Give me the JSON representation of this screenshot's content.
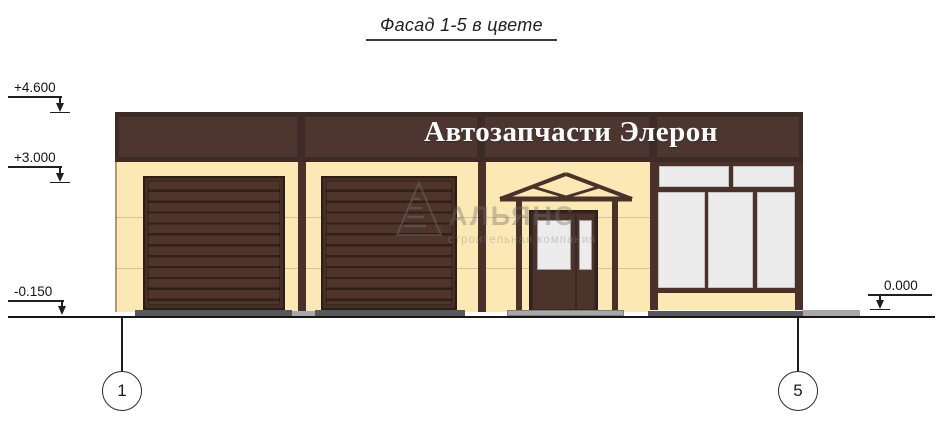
{
  "title": {
    "text": "Фасад 1-5 в цвете"
  },
  "sign": {
    "text": "Автозапчасти Элерон"
  },
  "elevation_marks": [
    {
      "id": "plus-4-600",
      "label": "+4.600"
    },
    {
      "id": "plus-3-000",
      "label": "+3.000"
    },
    {
      "id": "minus-0-150",
      "label": "-0.150"
    },
    {
      "id": "zero-0-000",
      "label": "0.000"
    }
  ],
  "axis_bubbles": [
    {
      "label": "1"
    },
    {
      "label": "5"
    }
  ],
  "watermark": {
    "name": "АЛЬЯНС",
    "tagline": "строительная компания"
  },
  "colors": {
    "facade_band": "#4e3630",
    "wall_cream": "#fbe8b5",
    "door_brown": "#4a322b",
    "glass": "#ececec",
    "pavement_dark": "#58585a",
    "pavement_light": "#a8a8a8",
    "sign_text": "#ffffff"
  }
}
